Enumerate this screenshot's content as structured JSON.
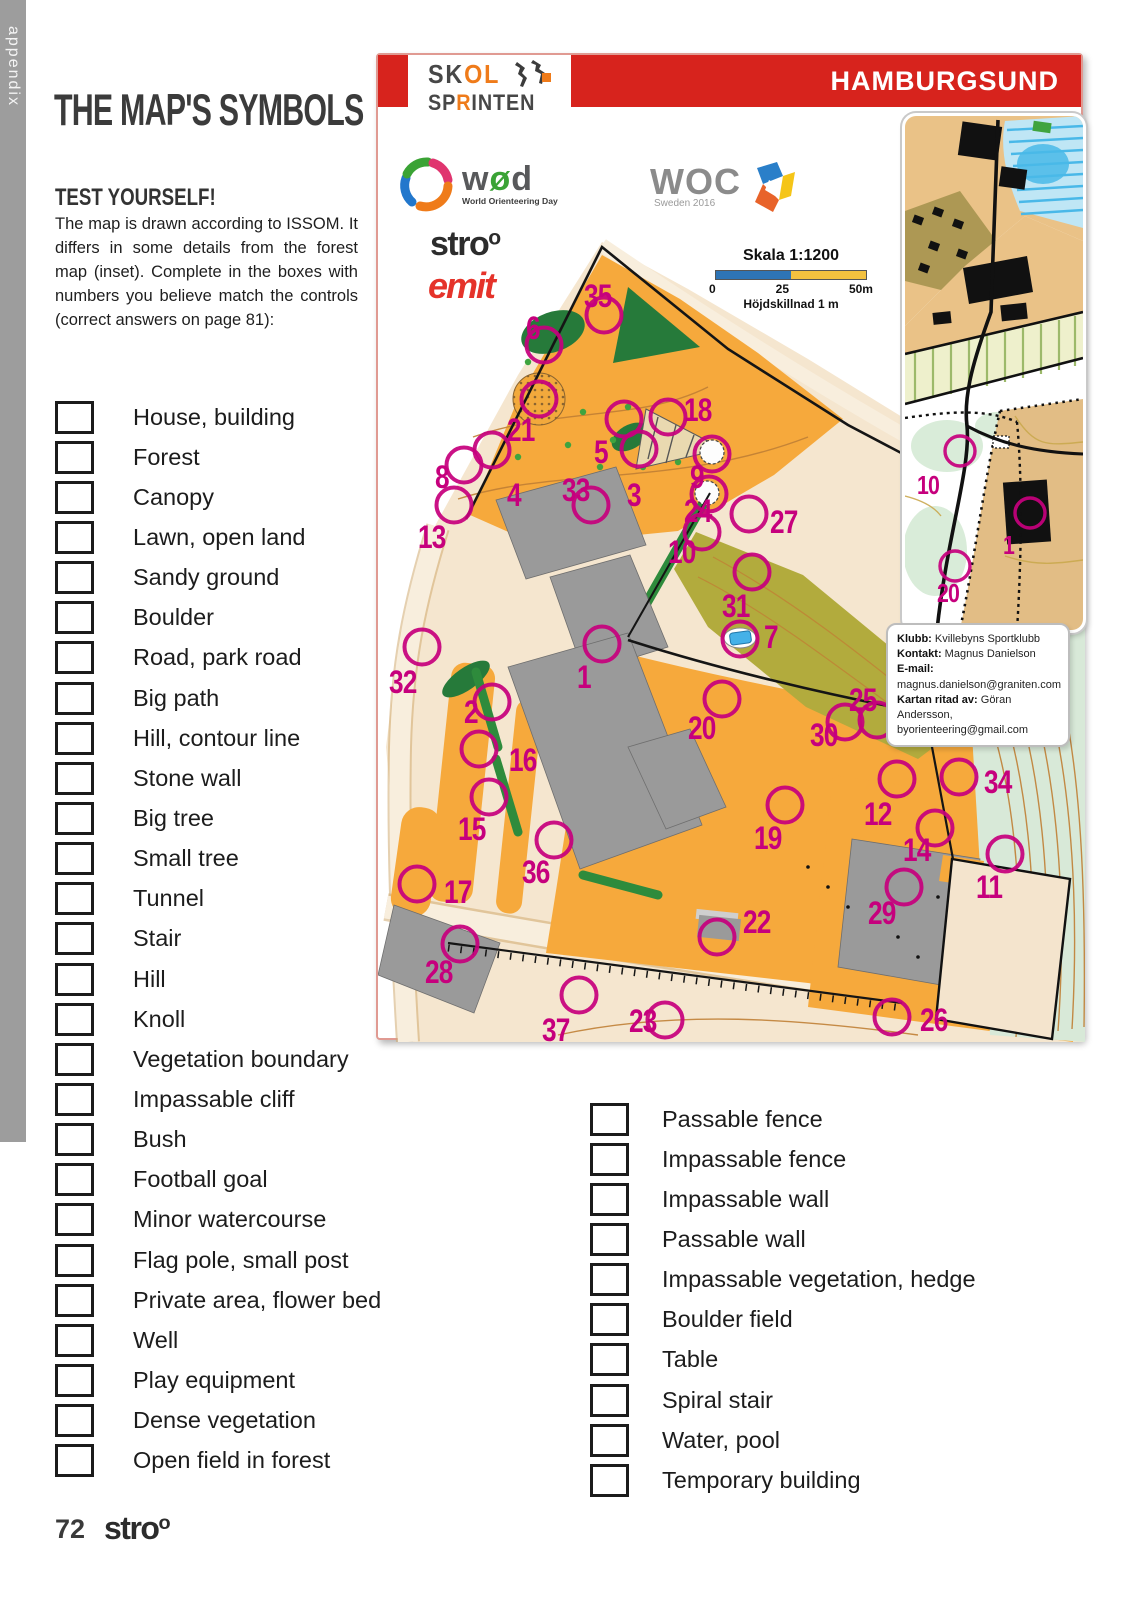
{
  "page": {
    "appendix_label": "appendix",
    "page_number": "72"
  },
  "left_panel": {
    "title": "THE MAP'S SYMBOLS",
    "test_yourself_heading": "TEST YOURSELF!",
    "intro_text": "The map is drawn according to ISSOM. It differs in some details from the forest map (inset). Complete in the boxes with numbers you believe match the controls (correct answers on page 81):",
    "symbol_list_left": [
      "House, building",
      "Forest",
      "Canopy",
      "Lawn, open land",
      "Sandy ground",
      "Boulder",
      "Road, park road",
      "Big path",
      "Hill, contour line",
      "Stone wall",
      "Big tree",
      "Small tree",
      "Tunnel",
      "Stair",
      "Hill",
      "Knoll",
      "Vegetation boundary",
      "Impassable cliff",
      "Bush",
      "Football goal",
      "Minor watercourse",
      "Flag pole, small post",
      "Private area, flower bed",
      "Well",
      "Play equipment",
      "Dense vegetation",
      "Open field in forest"
    ],
    "symbol_list_right": [
      "Passable fence",
      "Impassable fence",
      "Impassable wall",
      "Passable wall",
      "Impassable vegetation, hedge",
      "Boulder field",
      "Table",
      "Spiral stair",
      "Water, pool",
      "Temporary building"
    ]
  },
  "map_panel": {
    "region_title": "HAMBURGSUND",
    "logos": {
      "skol_part1": "SK",
      "skol_part2": "OL",
      "sprinten_part1": "SP",
      "sprinten_part2": "R",
      "sprinten_part3": "INTEN",
      "wod_w": "w",
      "wod_o": "ø",
      "wod_d": "d",
      "wod_subtext": "World Orienteering Day",
      "woc_text": "WOC",
      "woc_subtext": "Sweden 2016",
      "stroo_part1": "str",
      "stroo_part2": "o",
      "stroo_part3": "o",
      "emit_text": "emit"
    },
    "scale": {
      "title": "Skala 1:1200",
      "tick0": "0",
      "tick25": "25",
      "tick50": "50m",
      "contour_note": "Höjdskillnad 1 m"
    },
    "info_box": {
      "klubb_label": "Klubb:",
      "klubb_value": " Kvillebyns Sportklubb",
      "kontakt_label": "Kontakt:",
      "kontakt_value": " Magnus Danielson",
      "email_label": "E-mail:",
      "email_value": "magnus.danielson@graniten.com",
      "kartan_label": "Kartan ritad av:",
      "kartan_value": " Göran Andersson,",
      "kartan_value2": "byorienteering@gmail.com"
    },
    "colors": {
      "overprint_magenta": "#c6007d",
      "band_red": "#d7231d",
      "map_orange": "#f6a93c",
      "building_gray": "#9a9a9a",
      "olive_green": "#b2ab3d",
      "park_green": "#267a3a",
      "scale_blue": "#2e74b5",
      "scale_yellow": "#f3c13f",
      "emit_red": "#e5332a",
      "skol_orange": "#ef7b1a"
    },
    "controls": [
      {
        "n": "1",
        "cx": 224,
        "cy": 537,
        "lx": 199,
        "ly": 581
      },
      {
        "n": "2",
        "cx": 114,
        "cy": 595,
        "lx": 86,
        "ly": 616
      },
      {
        "n": "3",
        "cx": 261,
        "cy": 342,
        "lx": 249,
        "ly": 399
      },
      {
        "n": "4",
        "cx": 114,
        "cy": 343,
        "lx": 129,
        "ly": 399
      },
      {
        "n": "5",
        "cx": 246,
        "cy": 312,
        "lx": 216,
        "ly": 356
      },
      {
        "n": "6",
        "cx": 166,
        "cy": 238,
        "lx": 148,
        "ly": 232
      },
      {
        "n": "7",
        "cx": 362,
        "cy": 532,
        "lx": 386,
        "ly": 541
      },
      {
        "n": "8",
        "cx": 86,
        "cy": 358,
        "lx": 57,
        "ly": 381
      },
      {
        "n": "9",
        "cx": 334,
        "cy": 347,
        "lx": 312,
        "ly": 381
      },
      {
        "n": "10",
        "cx": 324,
        "cy": 425,
        "lx": 290,
        "ly": 456
      },
      {
        "n": "11",
        "cx": 627,
        "cy": 747,
        "lx": 598,
        "ly": 791
      },
      {
        "n": "12",
        "cx": 519,
        "cy": 672,
        "lx": 486,
        "ly": 718
      },
      {
        "n": "13",
        "cx": 76,
        "cy": 398,
        "lx": 40,
        "ly": 441
      },
      {
        "n": "14",
        "cx": 557,
        "cy": 721,
        "lx": 525,
        "ly": 754
      },
      {
        "n": "15",
        "cx": 111,
        "cy": 690,
        "lx": 80,
        "ly": 733
      },
      {
        "n": "16",
        "cx": 101,
        "cy": 642,
        "lx": 131,
        "ly": 664
      },
      {
        "n": "17",
        "cx": 39,
        "cy": 777,
        "lx": 66,
        "ly": 796
      },
      {
        "n": "18",
        "cx": 290,
        "cy": 310,
        "lx": 306,
        "ly": 314
      },
      {
        "n": "19",
        "cx": 407,
        "cy": 698,
        "lx": 376,
        "ly": 742
      },
      {
        "n": "20",
        "cx": 344,
        "cy": 592,
        "lx": 310,
        "ly": 632
      },
      {
        "n": "21",
        "cx": 161,
        "cy": 292,
        "lx": 129,
        "ly": 334
      },
      {
        "n": "22",
        "cx": 339,
        "cy": 830,
        "lx": 365,
        "ly": 826
      },
      {
        "n": "23",
        "cx": 287,
        "cy": 913,
        "lx": 251,
        "ly": 925
      },
      {
        "n": "24",
        "cx": 331,
        "cy": 387,
        "lx": 306,
        "ly": 415
      },
      {
        "n": "25",
        "cx": 499,
        "cy": 613,
        "lx": 471,
        "ly": 604
      },
      {
        "n": "26",
        "cx": 514,
        "cy": 910,
        "lx": 542,
        "ly": 924
      },
      {
        "n": "27",
        "cx": 371,
        "cy": 407,
        "lx": 392,
        "ly": 426
      },
      {
        "n": "28",
        "cx": 82,
        "cy": 837,
        "lx": 47,
        "ly": 876
      },
      {
        "n": "29",
        "cx": 526,
        "cy": 780,
        "lx": 490,
        "ly": 817
      },
      {
        "n": "30",
        "cx": 467,
        "cy": 615,
        "lx": 432,
        "ly": 639
      },
      {
        "n": "31",
        "cx": 374,
        "cy": 465,
        "lx": 344,
        "ly": 510
      },
      {
        "n": "32",
        "cx": 44,
        "cy": 540,
        "lx": 11,
        "ly": 586
      },
      {
        "n": "33",
        "cx": 213,
        "cy": 398,
        "lx": 184,
        "ly": 394
      },
      {
        "n": "34",
        "cx": 581,
        "cy": 670,
        "lx": 606,
        "ly": 686
      },
      {
        "n": "35",
        "cx": 226,
        "cy": 208,
        "lx": 206,
        "ly": 200
      },
      {
        "n": "36",
        "cx": 176,
        "cy": 733,
        "lx": 144,
        "ly": 776
      },
      {
        "n": "37",
        "cx": 201,
        "cy": 888,
        "lx": 164,
        "ly": 934
      }
    ],
    "inset_controls": [
      {
        "n": "10",
        "cx": 55,
        "cy": 335,
        "lx": 12,
        "ly": 378
      },
      {
        "n": "1",
        "cx": 125,
        "cy": 397,
        "lx": 98,
        "ly": 438
      },
      {
        "n": "20",
        "cx": 50,
        "cy": 450,
        "lx": 32,
        "ly": 486
      }
    ]
  }
}
